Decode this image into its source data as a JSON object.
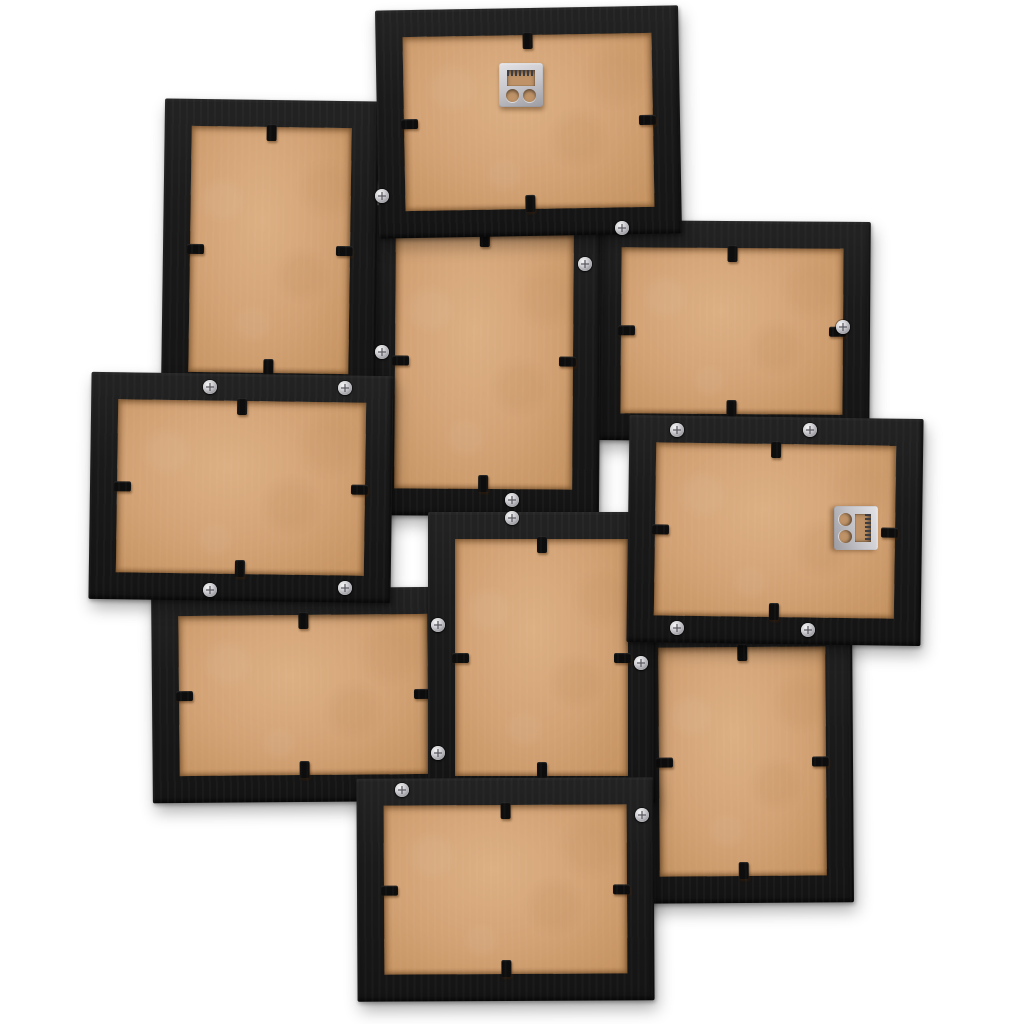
{
  "scene": {
    "description": "Back view of a black wall collage picture frame holding 10 photo frames, showing brown MDF back panels, black swivel tabs, silver assembly screws and two metal sawtooth hanging brackets on a white background",
    "photo_count": 10,
    "background": "#ffffff",
    "colors": {
      "frame_black": "#1a1a1a",
      "mdf_brown": "#d3a376",
      "mdf_brown_dark": "#c4925f",
      "screw_silver": "#c9c9cd",
      "hanger_silver": "#c6c6cb",
      "tab_black": "#0d0d0d"
    },
    "border_width": 27,
    "tabs_per_frame": [
      "top",
      "right",
      "bottom",
      "left"
    ],
    "frames": [
      {
        "id": "frame-1",
        "orientation": "landscape",
        "x": 377,
        "y": 8,
        "w": 303,
        "h": 228,
        "rot": -1.0,
        "z": 6
      },
      {
        "id": "frame-2",
        "orientation": "portrait",
        "x": 163,
        "y": 100,
        "w": 214,
        "h": 300,
        "rot": 0.8,
        "z": 3
      },
      {
        "id": "frame-3",
        "orientation": "portrait",
        "x": 368,
        "y": 206,
        "w": 232,
        "h": 310,
        "rot": 0.4,
        "z": 2
      },
      {
        "id": "frame-4",
        "orientation": "landscape",
        "x": 594,
        "y": 221,
        "w": 276,
        "h": 220,
        "rot": 0.4,
        "z": 1
      },
      {
        "id": "frame-5",
        "orientation": "landscape",
        "x": 90,
        "y": 374,
        "w": 302,
        "h": 227,
        "rot": 0.8,
        "z": 7
      },
      {
        "id": "frame-6",
        "orientation": "landscape",
        "x": 628,
        "y": 417,
        "w": 294,
        "h": 227,
        "rot": 0.8,
        "z": 7
      },
      {
        "id": "frame-7",
        "orientation": "portrait",
        "x": 428,
        "y": 512,
        "w": 227,
        "h": 291,
        "rot": 0.0,
        "z": 5
      },
      {
        "id": "frame-8",
        "orientation": "landscape",
        "x": 152,
        "y": 588,
        "w": 303,
        "h": 214,
        "rot": -0.5,
        "z": 4
      },
      {
        "id": "frame-9",
        "orientation": "portrait",
        "x": 632,
        "y": 620,
        "w": 221,
        "h": 283,
        "rot": -0.4,
        "z": 2
      },
      {
        "id": "frame-10",
        "orientation": "landscape",
        "x": 357,
        "y": 778,
        "w": 297,
        "h": 223,
        "rot": -0.3,
        "z": 8
      }
    ],
    "screws": [
      [
        382,
        196
      ],
      [
        622,
        228
      ],
      [
        585,
        264
      ],
      [
        843,
        327
      ],
      [
        382,
        352
      ],
      [
        210,
        387
      ],
      [
        345,
        388
      ],
      [
        677,
        430
      ],
      [
        810,
        430
      ],
      [
        512,
        500
      ],
      [
        512,
        518
      ],
      [
        345,
        588
      ],
      [
        210,
        590
      ],
      [
        438,
        625
      ],
      [
        677,
        628
      ],
      [
        808,
        630
      ],
      [
        641,
        663
      ],
      [
        438,
        753
      ],
      [
        402,
        790
      ],
      [
        642,
        815
      ]
    ],
    "hangers": [
      {
        "frame": "frame-1",
        "cx": 521,
        "cy": 85,
        "rot": 0
      },
      {
        "frame": "frame-6",
        "cx": 856,
        "cy": 528,
        "rot": 90
      }
    ]
  }
}
